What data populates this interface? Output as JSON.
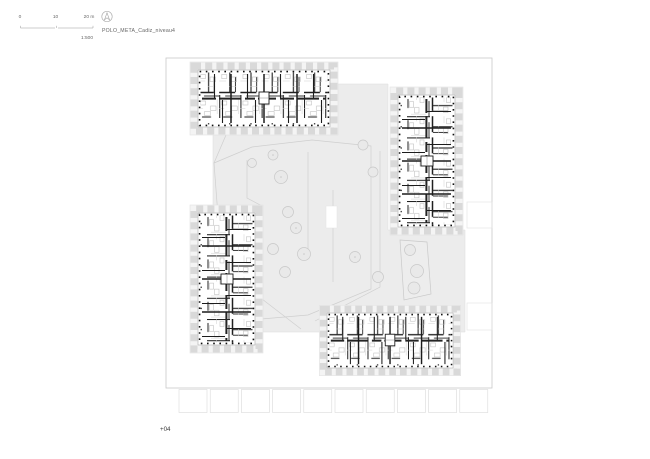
{
  "titleblock": {
    "project_title": "POLO_META_Cadiz_niveau4",
    "scale_ratio": "1:500",
    "scale_ticks": [
      "0",
      "10",
      "20 m"
    ]
  },
  "footer": {
    "level_label": "+04"
  },
  "icons": {
    "north": "north-arrow-icon"
  },
  "plan": {
    "kind": "residential floor plan - four apartment blocks around a landscaped courtyard",
    "blocks": [
      {
        "name": "block-north",
        "orientation": "horizontal"
      },
      {
        "name": "block-east",
        "orientation": "vertical"
      },
      {
        "name": "block-west",
        "orientation": "vertical"
      },
      {
        "name": "block-south",
        "orientation": "horizontal"
      }
    ],
    "tree_count": 15,
    "colors": {
      "wall": "#1c1c1c",
      "column_dots": "#101010",
      "balcony_fringe": "#d9d9d9",
      "fringe_fill": "#f4f4f4",
      "courtyard_fill": "#ececec",
      "landscape_line": "#cfcfcf",
      "boundary_line": "#c9c9c9",
      "text": "#666666",
      "background": "#ffffff"
    }
  }
}
